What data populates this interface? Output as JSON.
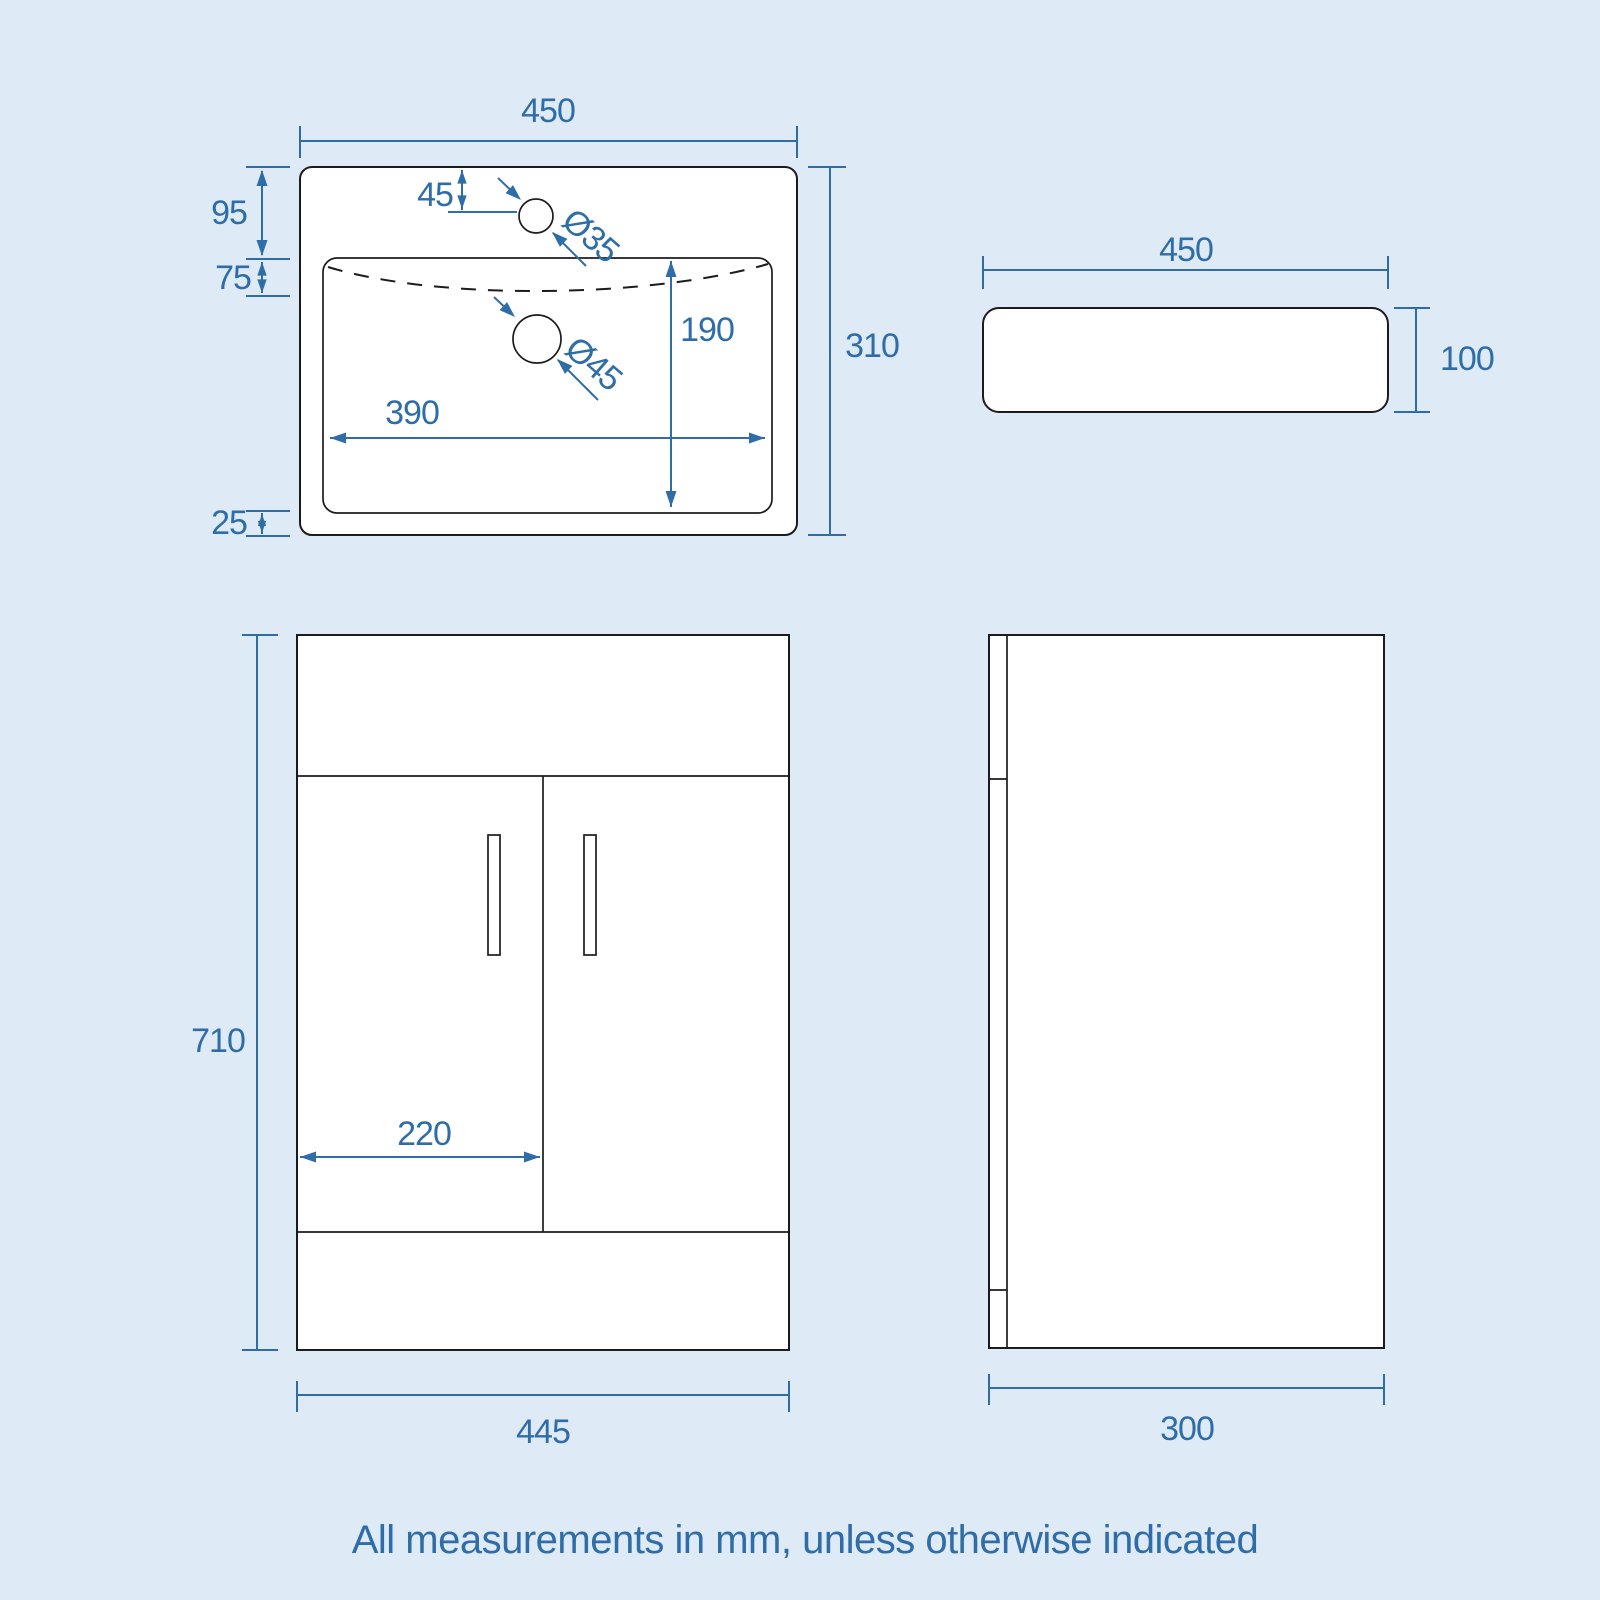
{
  "diagram": {
    "footnote": "All measurements in mm, unless otherwise indicated",
    "colors": {
      "background": "#deeaf6",
      "dimension_blue": "#2e6da8",
      "outline_dark": "#1c1c1e",
      "surface_white": "#ffffff"
    },
    "views": {
      "basin_top": {
        "width": "450",
        "depth": "310",
        "rim_to_bowl": "95",
        "bowl_lip": "75",
        "bowl_to_front": "25",
        "tap_inset": "45",
        "tap_hole_diameter": "Ø35",
        "waste_hole_diameter": "Ø45",
        "bowl_depth": "190",
        "bowl_width": "390"
      },
      "basin_side": {
        "width": "450",
        "height": "100"
      },
      "cabinet_front": {
        "height": "710",
        "door_width": "220",
        "width": "445"
      },
      "cabinet_side": {
        "depth": "300"
      }
    }
  }
}
